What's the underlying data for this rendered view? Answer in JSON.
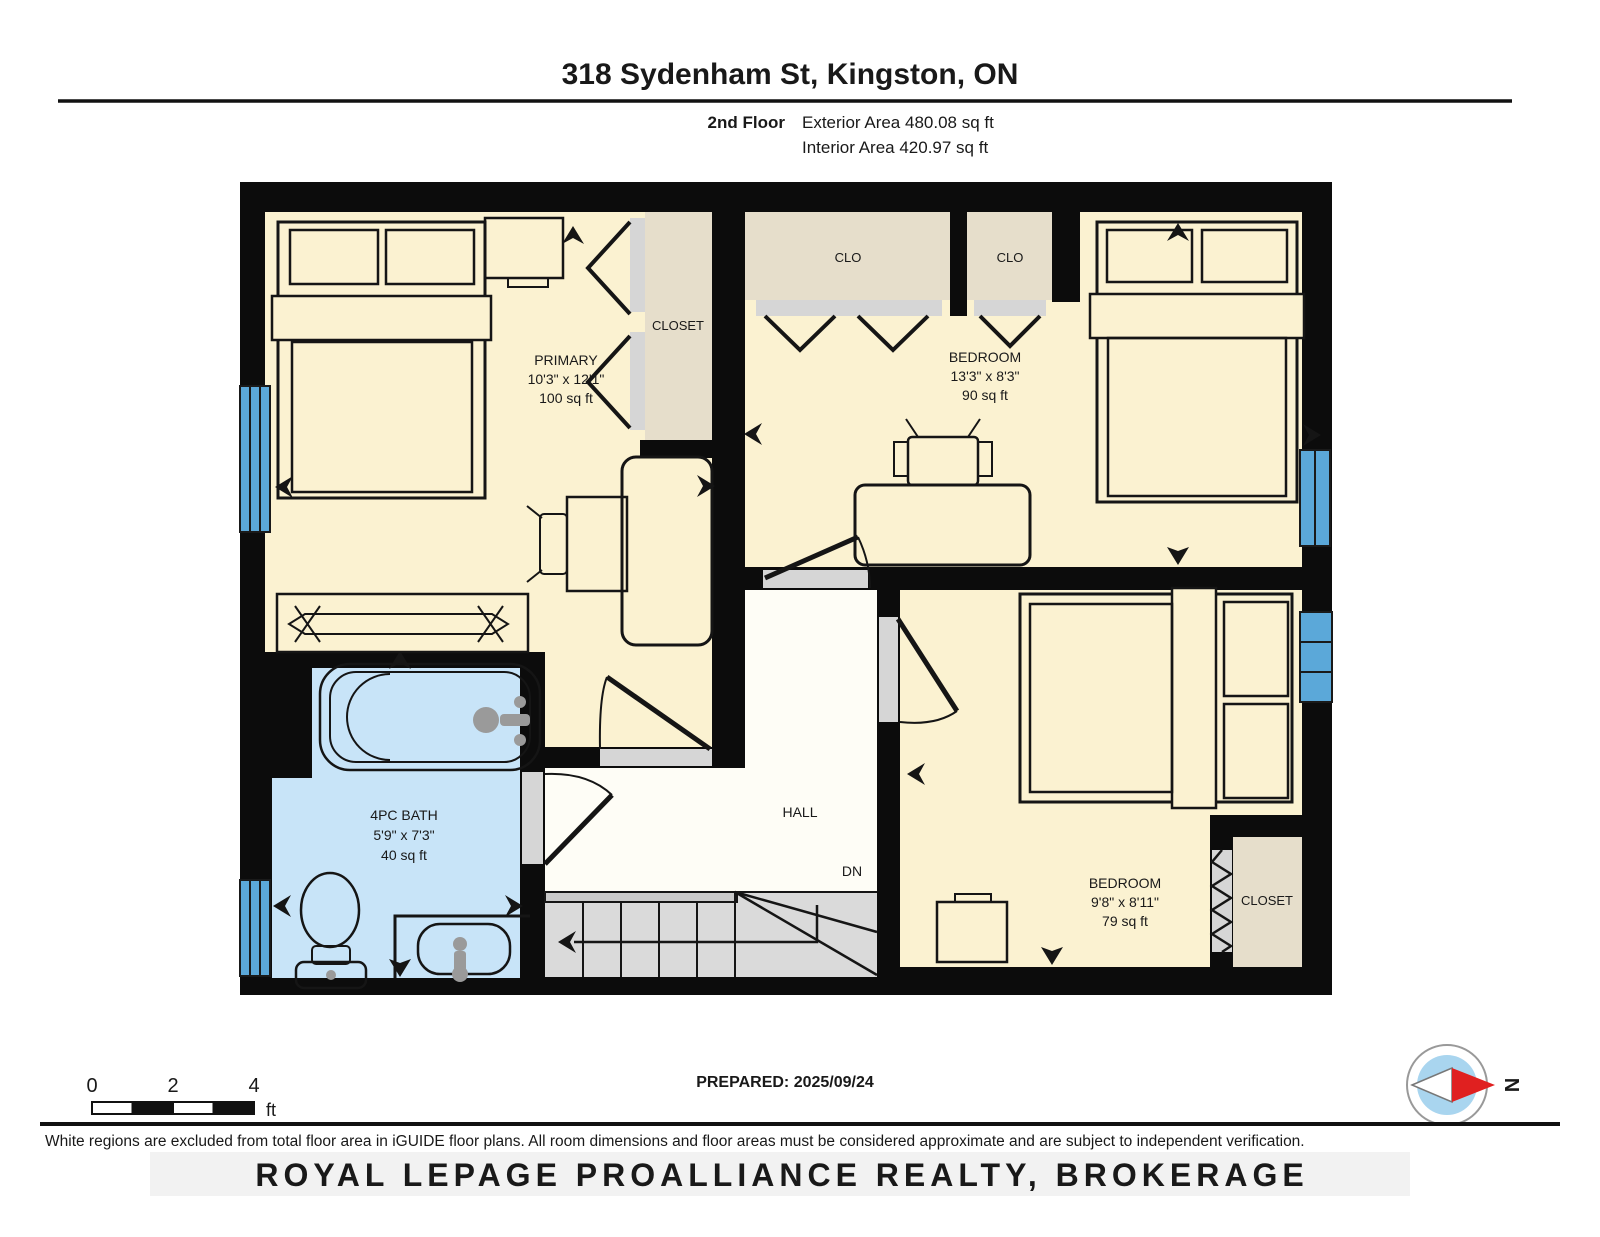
{
  "header": {
    "title": "318 Sydenham St, Kingston, ON",
    "floor_label": "2nd Floor",
    "exterior_area": "Exterior Area 480.08 sq ft",
    "interior_area": "Interior Area 420.97 sq ft"
  },
  "rooms": {
    "primary": {
      "name": "PRIMARY",
      "dims": "10'3\" x 12'1\"",
      "area": "100 sq ft"
    },
    "bedroom_top": {
      "name": "BEDROOM",
      "dims": "13'3\" x 8'3\"",
      "area": "90 sq ft"
    },
    "bedroom_bottom": {
      "name": "BEDROOM",
      "dims": "9'8\" x 8'11\"",
      "area": "79 sq ft"
    },
    "bath": {
      "name": "4PC BATH",
      "dims": "5'9\" x 7'3\"",
      "area": "40 sq ft"
    },
    "hall": {
      "name": "HALL",
      "down_label": "DN"
    },
    "closet_primary": {
      "name": "CLOSET"
    },
    "closet_bottom": {
      "name": "CLOSET"
    },
    "clo_left": {
      "name": "CLO"
    },
    "clo_right": {
      "name": "CLO"
    }
  },
  "scale_bar": {
    "ticks": [
      "0",
      "2",
      "4"
    ],
    "unit": "ft"
  },
  "prepared_label": "PREPARED: 2025/09/24",
  "compass_label": "N",
  "footer": {
    "disclaimer": "White regions are excluded from total floor area in iGUIDE floor plans. All room dimensions and floor areas must be considered approximate and are subject to independent verification.",
    "watermark": "ROYAL LEPAGE PROALLIANCE REALTY, BROKERAGE"
  },
  "colors": {
    "wall": "#0c0c0c",
    "room_cream": "#fbf2d1",
    "closet_tan": "#e6decb",
    "bath_blue": "#c8e4f8",
    "window_blue": "#5ba8d9",
    "door_gray": "#d6d6d6",
    "stair_gray": "#dadada",
    "stair_nosing": "#c9c9c9",
    "excluded_white": "#fefdf6",
    "fixture_gray": "#9a9a9a",
    "compass_blue": "#a9d5ef",
    "compass_red": "#e02020",
    "watermark_gray": "#cccccc"
  }
}
